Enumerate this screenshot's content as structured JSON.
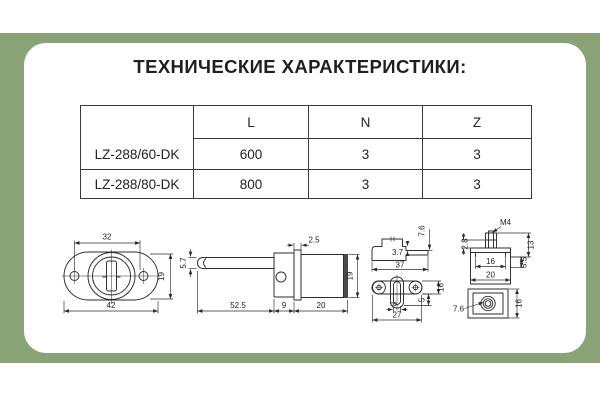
{
  "frame_color": "#8aa376",
  "title": "ТЕХНИЧЕСКИЕ ХАРАКТЕРИСТИКИ:",
  "table": {
    "columns": [
      "",
      "L",
      "N",
      "Z"
    ],
    "rows": [
      {
        "name": "LZ-288/60-DK",
        "L": "600",
        "N": "3",
        "Z": "3"
      },
      {
        "name": "LZ-288/80-DK",
        "L": "800",
        "N": "3",
        "Z": "3"
      }
    ]
  },
  "drawings": {
    "plate": {
      "hole_spacing": "32",
      "total_width": "42",
      "height": "19"
    },
    "lock_side": {
      "rod_diameter": "5.7",
      "flange": "2.5",
      "rod_length": "52.5",
      "block_width": "9",
      "body_length": "20",
      "body_height": "19"
    },
    "bracket": {
      "arm_height": "7.6",
      "step": "3.7",
      "width": "37",
      "slot_width": "8",
      "offset": "5",
      "bar_height": "16",
      "hole_spacing": "27"
    },
    "strike": {
      "thread": "M4",
      "stud_height": "13",
      "collar": "2.8",
      "inner_width": "16",
      "outer_width": "20",
      "lip": "5.5",
      "hole_diameter": "7.6",
      "plan_height": "16"
    }
  }
}
